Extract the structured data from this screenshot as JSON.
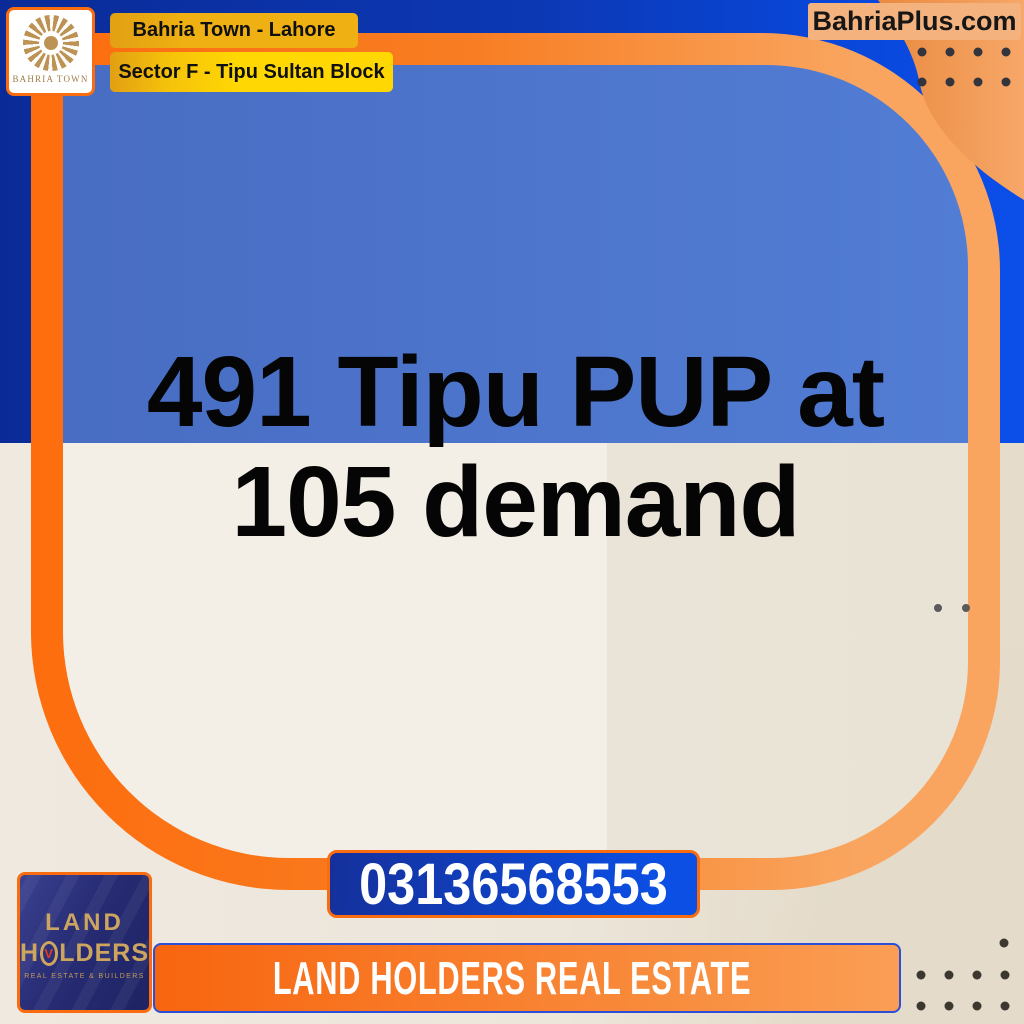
{
  "header": {
    "bahria_logo_caption": "BAHRIA TOWN",
    "location_primary": "Bahria Town - Lahore",
    "location_secondary": "Sector F - Tipu Sultan Block",
    "website": "BahriaPlus.com"
  },
  "listing": {
    "headline_line1": "491 Tipu PUP at",
    "headline_line2": "105 demand",
    "phone": "03136568553"
  },
  "agency": {
    "name_line1": "LAND",
    "name_line2_prefix": "H",
    "name_line2_suffix": "LDERS",
    "o_mark_glyph": "V",
    "tagline": "REAL ESTATE & BUILDERS",
    "banner_text": "LAND HOLDERS REAL ESTATE"
  },
  "colors": {
    "frame_orange": "#fd6d0e",
    "frame_orange_light": "#f9a55f",
    "navy_blue": "#0a2b97",
    "bright_blue": "#0b4ee9",
    "panel_blue": "#4d76cc",
    "panel_beige": "#f2eee6",
    "tan": "#e4dbca",
    "badge_amber": "#eeb012",
    "badge_yellow": "#ffd702",
    "website_peach": "#f3b27e",
    "phone_blue": "#0b4fe4",
    "banner_orange": "#f8650f",
    "gold": "#cda55f",
    "logo_navy": "#272c74"
  }
}
